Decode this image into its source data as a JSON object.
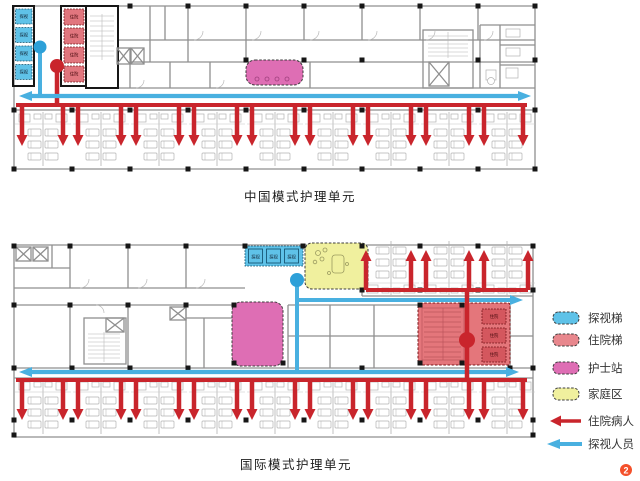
{
  "plans": {
    "top": {
      "title": "中国模式护理单元",
      "visit_label": "探视",
      "inpatient_label": "住院"
    },
    "bottom": {
      "title": "国际模式护理单元",
      "visit_label": "探视",
      "inpatient_label": "住院"
    }
  },
  "legend": {
    "items": [
      {
        "label": "探视梯",
        "type": "swatch",
        "color": "#5fc2e8"
      },
      {
        "label": "住院梯",
        "type": "swatch",
        "color": "#e8878d"
      },
      {
        "label": "护士站",
        "type": "swatch",
        "color": "#de6eb4"
      },
      {
        "label": "家庭区",
        "type": "swatch",
        "color": "#f0f09e"
      },
      {
        "label": "住院病人",
        "type": "arrow",
        "color": "#c9252c"
      },
      {
        "label": "探视人员",
        "type": "arrow",
        "color": "#49b0e0"
      }
    ]
  },
  "badge": {
    "number": "2",
    "color": "#f4502a"
  },
  "colors": {
    "flow_red": "#c9252c",
    "flow_blue": "#49b0e0",
    "visitor_blue": "#5fc2e8",
    "inpatient_red": "#e1767e",
    "nurse_pink": "#de6eb4",
    "family_yellow": "#f0f09e",
    "inpatient_zone": "#e4767b",
    "wall_gray": "#8f8f8f"
  }
}
